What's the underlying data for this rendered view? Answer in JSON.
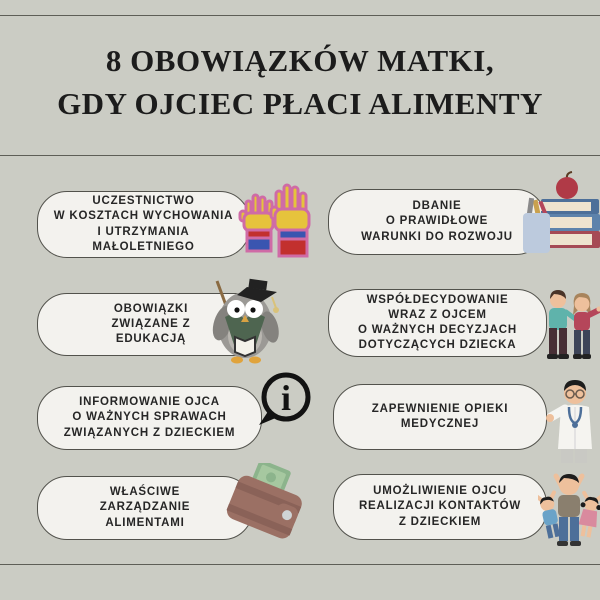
{
  "header": {
    "title_line1": "8 OBOWIĄZKÓW MATKI,",
    "title_line2": "GDY OJCIEC PŁACI ALIMENTY"
  },
  "colors": {
    "background": "#cbccc4",
    "card_fill": "#f3f2ee",
    "card_border": "#52524c",
    "text": "#262626",
    "divider": "#5e5e57",
    "hand_yellow": "#e6c33c",
    "hand_outline_pink": "#cf6ba6",
    "book_blue": "#4d6f99",
    "book_red": "#a64a55",
    "vest_green": "#4e6550",
    "shirt_teal": "#5fb3ab",
    "top_red": "#b5465a",
    "wallet_brown": "#9b7064",
    "money_green": "#8cb48c"
  },
  "duties": [
    {
      "id": 1,
      "text": "UCZESTNICTWO\nW KOSZTACH WYCHOWANIA\nI UTRZYMANIA\nMAŁOLETNIEGO",
      "icon": "raised-hands-icon"
    },
    {
      "id": 2,
      "text": "DBANIE\nO PRAWIDŁOWE\nWARUNKI DO ROZWOJU",
      "icon": "books-apple-icon"
    },
    {
      "id": 3,
      "text": "OBOWIĄZKI\nZWIĄZANE Z\nEDUKACJĄ",
      "icon": "graduate-owl-icon"
    },
    {
      "id": 4,
      "text": "WSPÓŁDECYDOWANIE\nWRAZ Z OJCEM\nO WAŻNYCH DECYZJACH\nDOTYCZĄCYCH DZIECKA",
      "icon": "parents-couple-icon"
    },
    {
      "id": 5,
      "text": "INFORMOWANIE OJCA\nO WAŻNYCH SPRAWACH\nZWIĄZANYCH Z DZIECKIEM",
      "icon": "info-bubble-icon"
    },
    {
      "id": 6,
      "text": "ZAPEWNIENIE OPIEKI\nMEDYCZNEJ",
      "icon": "doctor-icon"
    },
    {
      "id": 7,
      "text": "WŁAŚCIWE\nZARZĄDZANIE\nALIMENTAMI",
      "icon": "wallet-money-icon"
    },
    {
      "id": 8,
      "text": "UMOŻLIWIENIE OJCU\nREALIZACJI KONTAKTÓW\nZ DZIECKIEM",
      "icon": "family-children-icon"
    }
  ]
}
